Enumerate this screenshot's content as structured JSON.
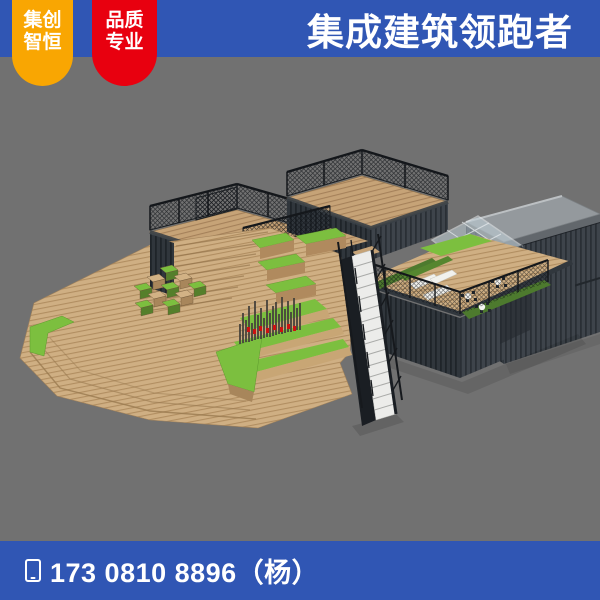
{
  "header": {
    "bar_color": "#3056B4",
    "title": "集成建筑领跑者",
    "badges": [
      {
        "id": "badge-jichuang-zhiheng",
        "color": "#F9A602",
        "lines": [
          "集创",
          "智恒"
        ]
      },
      {
        "id": "badge-pinzhi-zhuanye",
        "color": "#E8000F",
        "lines": [
          "品质",
          "专业"
        ]
      }
    ]
  },
  "footer": {
    "bar_color": "#3056B4",
    "phone_icon": "phone-icon",
    "phone": "173 0810 8896（杨）"
  },
  "canvas": {
    "background": "#717171",
    "scene_type": "3d-architectural-render",
    "scene_subject": "Container-style building with rooftop viewing decks and black mesh railings, second-floor lounge terrace with hedge planters, white sofas and dining sets, glass canopy, external white staircase, stacked dark corrugated shipping containers, and a large wooden stepped amphitheater plaza with green lawn terraces, checkerboard planter cubes and a timber-slat sign bearing small red characters",
    "scene_colors": {
      "wood": "#CFAF83",
      "wood_dark": "#A8865B",
      "grass": "#7CBF3F",
      "hedge": "#4D7A2E",
      "container": "#3E444B",
      "container_shaded": "#30363C",
      "railing": "#1A1E23",
      "stairs": "#ECECEA",
      "glass": "#C2D2DA",
      "roof_slab": "#94999D",
      "sign_red": "#CC1111"
    }
  }
}
